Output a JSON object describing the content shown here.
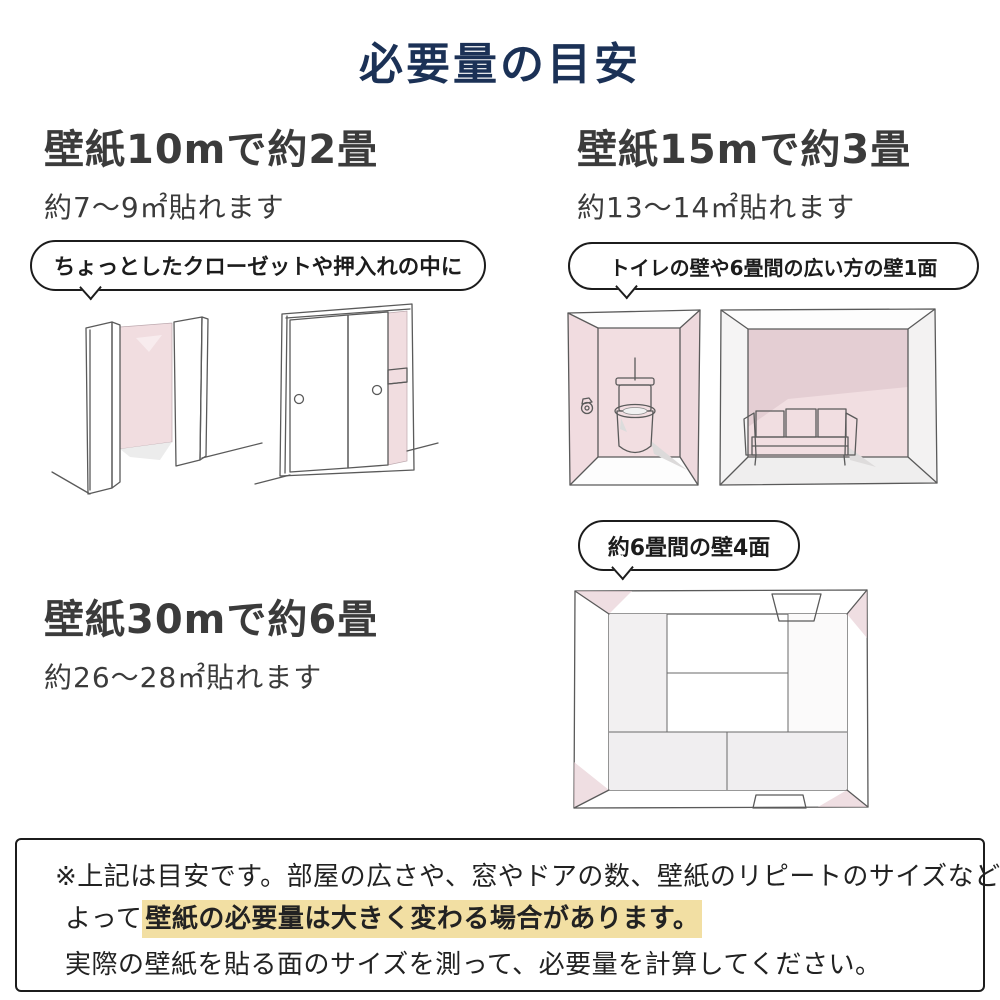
{
  "page": {
    "title": "必要量の目安"
  },
  "sections": {
    "s10m": {
      "heading": "壁紙10mで約2畳",
      "subheading": "約7〜9㎡貼れます",
      "bubble": "ちょっとしたクローゼットや押入れの中に"
    },
    "s15m": {
      "heading": "壁紙15mで約3畳",
      "subheading": "約13〜14㎡貼れます",
      "bubble": "トイレの壁や6畳間の広い方の壁1面"
    },
    "s30m": {
      "heading": "壁紙30mで約6畳",
      "subheading": "約26〜28㎡貼れます",
      "bubble": "約6畳間の壁4面"
    },
    "illustrations": {
      "closet_open": "open-closet-sketch",
      "closet_sliding": "sliding-door-closet-sketch",
      "toilet_room": "toilet-room-sketch",
      "sofa_room": "six-mat-room-wide-wall-sketch",
      "tatami_room": "six-mat-room-four-walls-top-view-sketch"
    }
  },
  "note": {
    "line1": "※上記は目安です。部屋の広さや、窓やドアの数、壁紙のリピートのサイズなどに",
    "line2_prefix": "よって",
    "line2_highlight": "壁紙の必要量は大きく変わる場合があります。",
    "line3": "実際の壁紙を貼る面のサイズを測って、必要量を計算してください。"
  },
  "colors": {
    "title_navy": "#1b3156",
    "heading_gray": "#3b3b3b",
    "wall_pink": "#f1dde0",
    "wall_pink_dark": "#e4ced3",
    "highlight_yellow": "#f2dfa3",
    "sketch_line": "#5a5a5a"
  }
}
